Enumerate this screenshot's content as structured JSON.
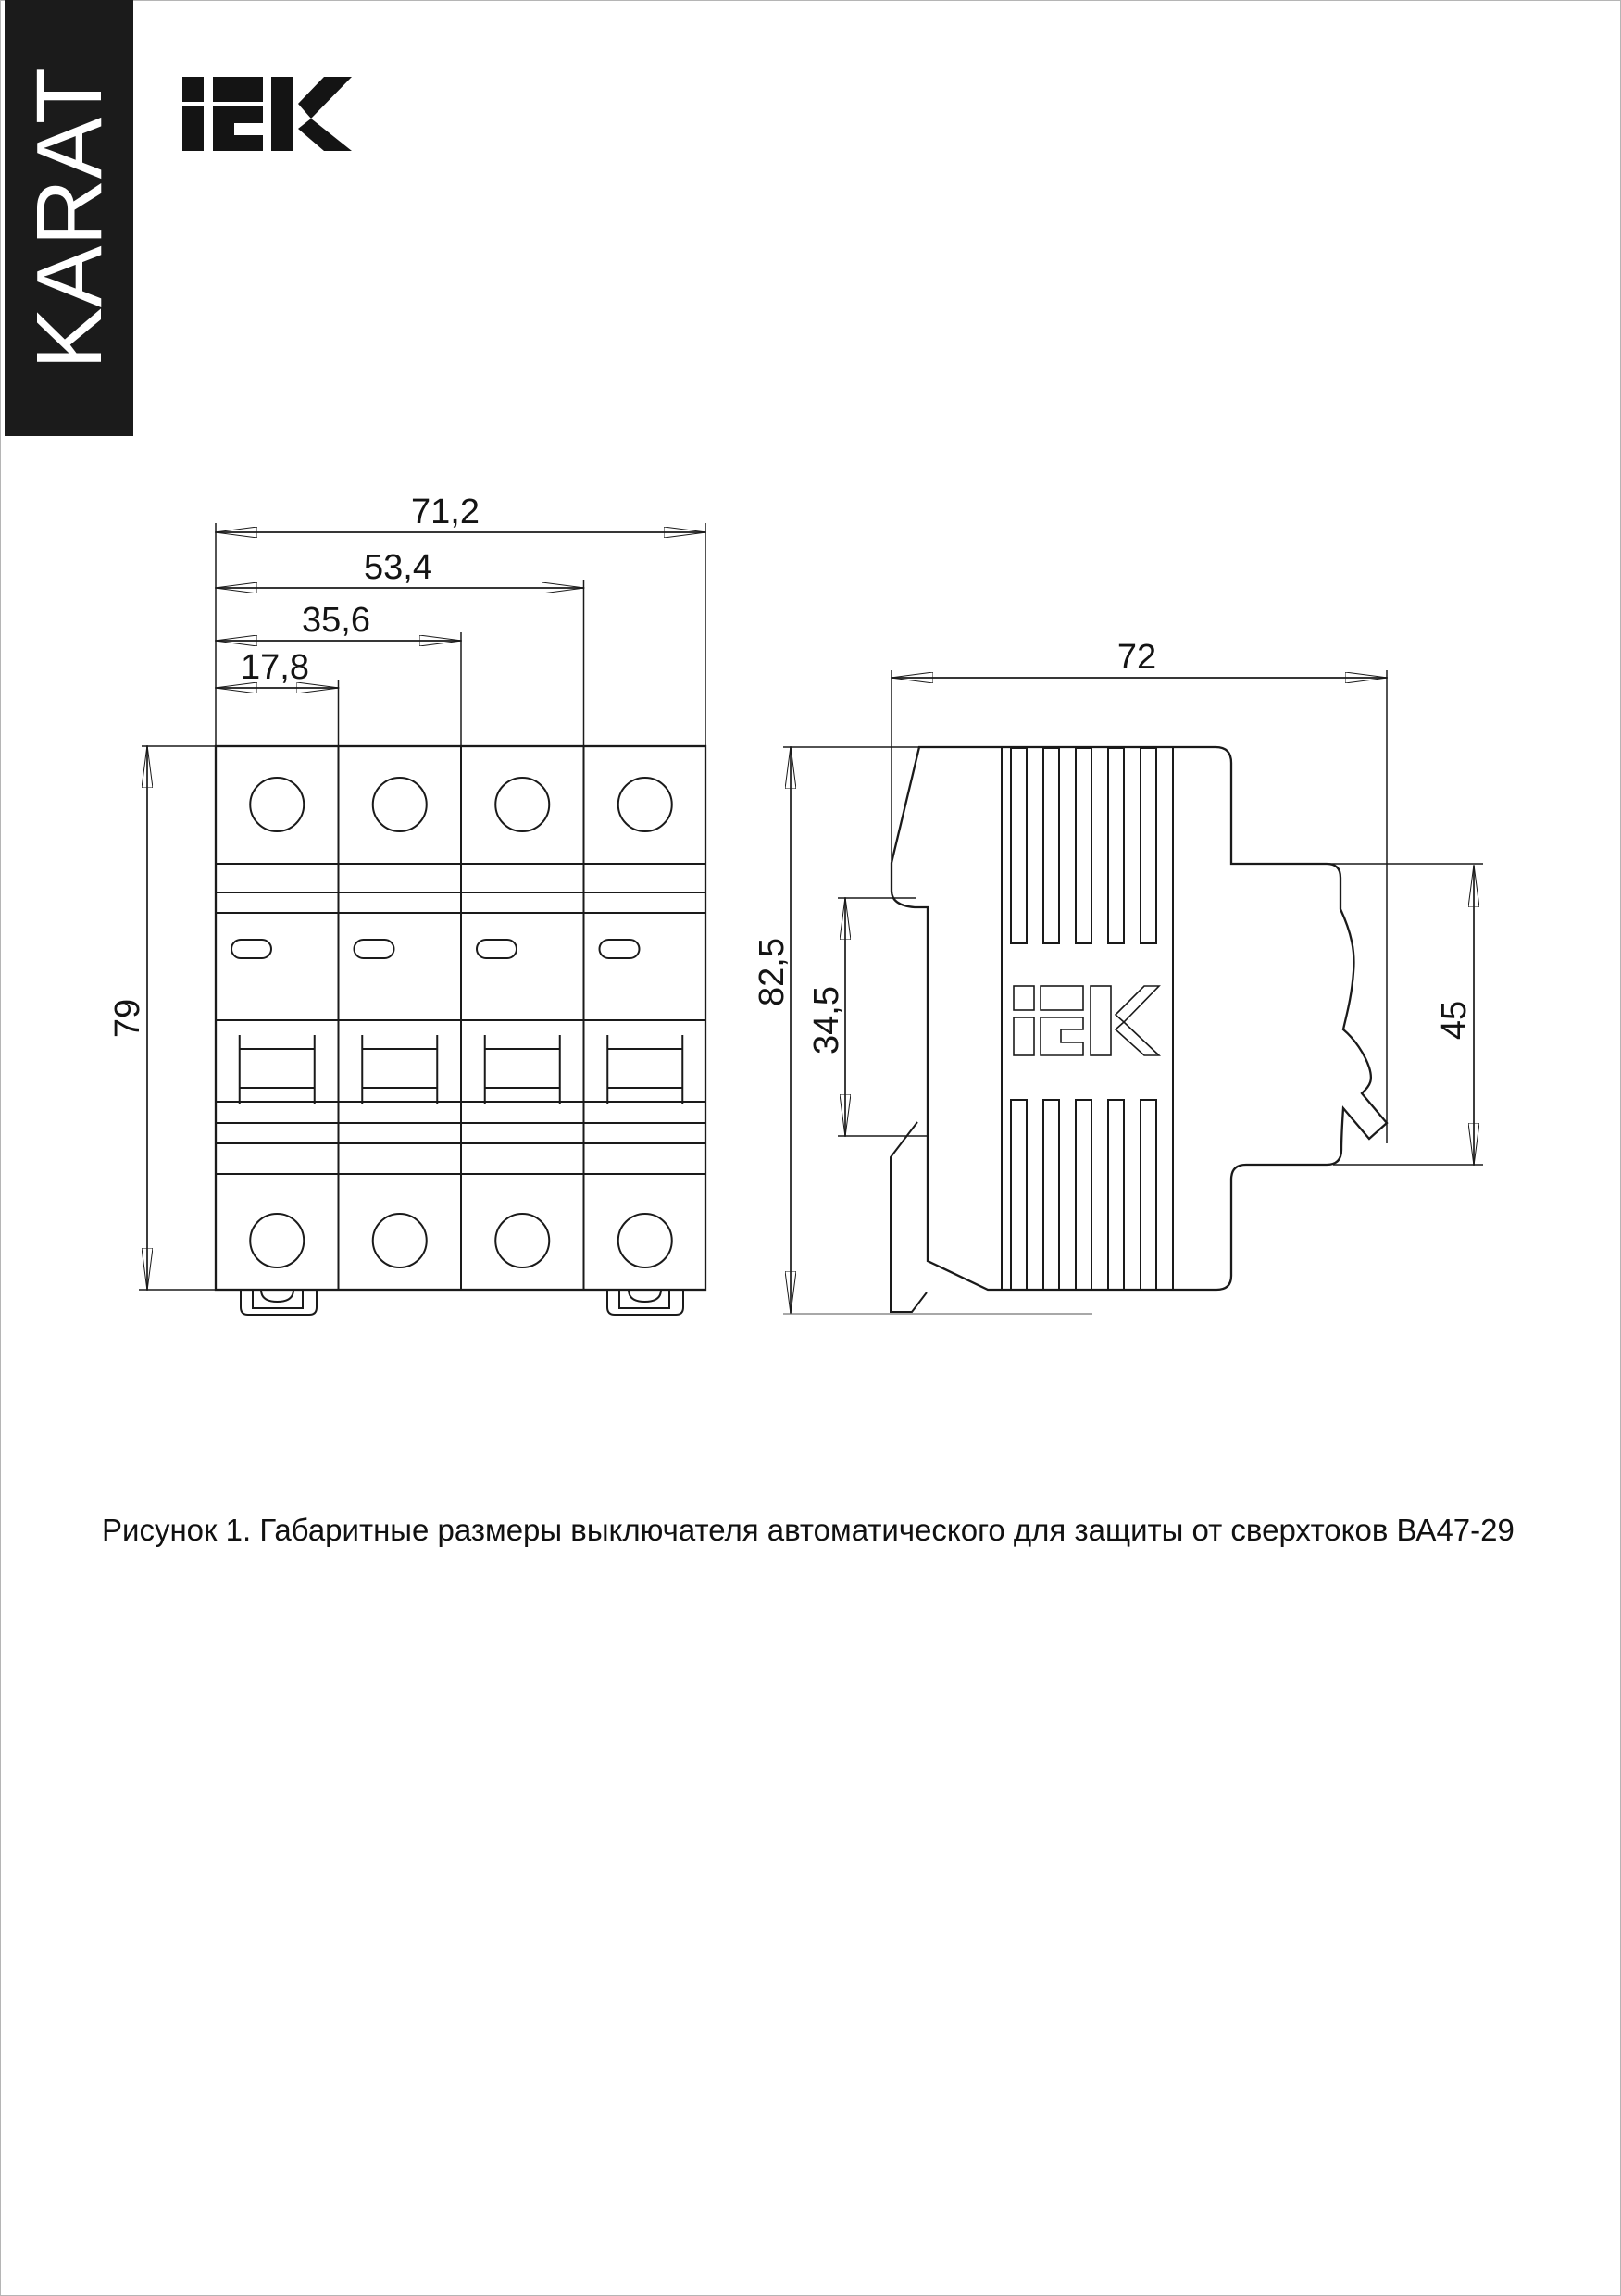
{
  "banner": {
    "text": "KARAT"
  },
  "logo": {
    "text": "iEK"
  },
  "figure": {
    "caption": "Рисунок 1. Габаритные размеры выключателя автоматического для защиты от сверхтоков ВА47-29",
    "front_view": {
      "dim_width_total": "71,2",
      "dim_width_three_modules": "53,4",
      "dim_width_two_modules": "35,6",
      "dim_width_one_module": "17,8",
      "dim_height": "79"
    },
    "side_view": {
      "dim_depth": "72",
      "dim_height": "82,5",
      "dim_din_slot": "34,5",
      "dim_front_depth": "45",
      "logo_text": "iEK"
    }
  },
  "colors": {
    "ink": "#1a1a1a",
    "banner_bg": "#1b1b1b",
    "paper": "#ffffff",
    "extension_gray": "#8c8c8c"
  }
}
